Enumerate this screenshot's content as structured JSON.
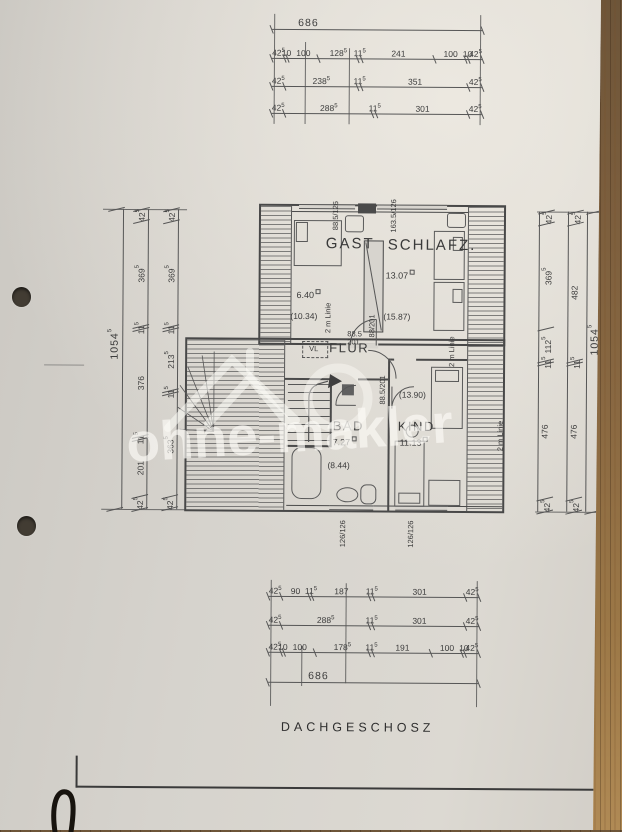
{
  "document": {
    "floor_label": "DACHGESCHOSZ",
    "watermark_text": "ohne-makler",
    "paper_color": "#d6d3cd",
    "ink_color": "#4a4a4a",
    "wood_color": "#8a6942"
  },
  "dimensions": {
    "top": {
      "total": [
        "686"
      ],
      "row1": [
        "42.5",
        "10",
        "100",
        "128.5",
        "11.5",
        "241",
        "100",
        "10",
        "42.5"
      ],
      "row2": [
        "42.5",
        "238.5",
        "11.5",
        "351",
        "42.5"
      ],
      "row3": [
        "42.5",
        "288.5",
        "11.5",
        "301",
        "42.5"
      ]
    },
    "bottom": {
      "row1": [
        "42.5",
        "90",
        "11.5",
        "187",
        "11.5",
        "301",
        "42.5"
      ],
      "row2": [
        "42.5",
        "288.5",
        "11.5",
        "301",
        "42.5"
      ],
      "row3": [
        "42.5",
        "10",
        "100",
        "178.5",
        "11.5",
        "191",
        "100",
        "10",
        "42.5"
      ],
      "total": [
        "686"
      ]
    },
    "left": {
      "total": [
        "1054.5"
      ],
      "outer": [
        "42.5",
        "369.5",
        "11.5",
        "376",
        "11.5",
        "201",
        "42.5"
      ],
      "inner": [
        "42.5",
        "369.5",
        "11.5",
        "213.5",
        "11.5",
        "363.5",
        "42.5"
      ]
    },
    "right": {
      "inner": [
        "42.5",
        "369.5",
        "112.5",
        "11.5",
        "476",
        "42.5"
      ],
      "outer": [
        "42.5",
        "482",
        "11.5",
        "476",
        "42.5"
      ],
      "total": [
        "1054.5"
      ]
    }
  },
  "annotations": [
    {
      "name": "room-label-gast",
      "text": "GAST",
      "x": 325,
      "y": 236,
      "cls": "room-lg"
    },
    {
      "name": "room-label-schlafz",
      "text": "SCHLAFZ.",
      "x": 387,
      "y": 237,
      "cls": "room-lg"
    },
    {
      "name": "room-label-flur",
      "text": "FLUR",
      "x": 329,
      "y": 341,
      "cls": "room-md"
    },
    {
      "name": "room-label-bad",
      "text": "BAD",
      "x": 333,
      "y": 419,
      "cls": "room-md"
    },
    {
      "name": "room-label-kind",
      "text": "KIND",
      "x": 398,
      "y": 419,
      "cls": "room-md"
    },
    {
      "name": "room-area-gast",
      "text": "6.40",
      "x": 296,
      "y": 289,
      "cls": "area"
    },
    {
      "name": "room-area2-gast",
      "text": "(10.34)",
      "x": 290,
      "y": 312,
      "cls": "area2"
    },
    {
      "name": "room-area-schlafz",
      "text": "13.07",
      "x": 385,
      "y": 269,
      "cls": "area"
    },
    {
      "name": "room-area2-schlafz",
      "text": "(15.87)",
      "x": 383,
      "y": 312,
      "cls": "area2"
    },
    {
      "name": "room-area-bad",
      "text": "7.27",
      "x": 333,
      "y": 436,
      "cls": "area"
    },
    {
      "name": "room-area2-bad",
      "text": "(8.44)",
      "x": 328,
      "y": 461,
      "cls": "area2"
    },
    {
      "name": "room-area-kind",
      "text": "11.13",
      "x": 400,
      "y": 436,
      "cls": "area"
    },
    {
      "name": "room-area2-kind",
      "text": "(13.90)",
      "x": 399,
      "y": 390,
      "cls": "area2"
    },
    {
      "name": "vl-label",
      "text": "VL",
      "x": 309,
      "y": 345,
      "cls": "tiny"
    },
    {
      "name": "window-dim-gast",
      "text": "88.5/126",
      "x": 331,
      "y": 230,
      "rot": -90,
      "cls": "tiny"
    },
    {
      "name": "window-dim-schlafz",
      "text": "163.5/126",
      "x": 389,
      "y": 232,
      "rot": -90,
      "cls": "tiny"
    },
    {
      "name": "window-dim-bad",
      "text": "126/126",
      "x": 340,
      "y": 547,
      "rot": -90,
      "cls": "tiny"
    },
    {
      "name": "window-dim-kind",
      "text": "126/126",
      "x": 408,
      "y": 547,
      "rot": -90,
      "cls": "tiny"
    },
    {
      "name": "door-dim-flur-width",
      "text": "88.5",
      "x": 347,
      "y": 330,
      "cls": "tiny"
    },
    {
      "name": "door-dim-flur-height",
      "text": "201",
      "x": 347,
      "y": 338,
      "cls": "tiny"
    },
    {
      "name": "door-dim-gast",
      "text": "88/201",
      "x": 368,
      "y": 337,
      "rot": -90,
      "cls": "tiny"
    },
    {
      "name": "door-dim-kind",
      "text": "88.5/201",
      "x": 379,
      "y": 404,
      "rot": -90,
      "cls": "tiny"
    },
    {
      "name": "two-meter-line-gast",
      "text": "2 m Linie",
      "x": 324,
      "y": 333,
      "rot": -90,
      "cls": "tiny"
    },
    {
      "name": "two-meter-line-schlafz",
      "text": "2 m Linie",
      "x": 448,
      "y": 366,
      "rot": -90,
      "cls": "tiny"
    },
    {
      "name": "two-meter-line-kind",
      "text": "2 m Linie",
      "x": 497,
      "y": 450,
      "rot": -90,
      "cls": "tiny"
    }
  ]
}
